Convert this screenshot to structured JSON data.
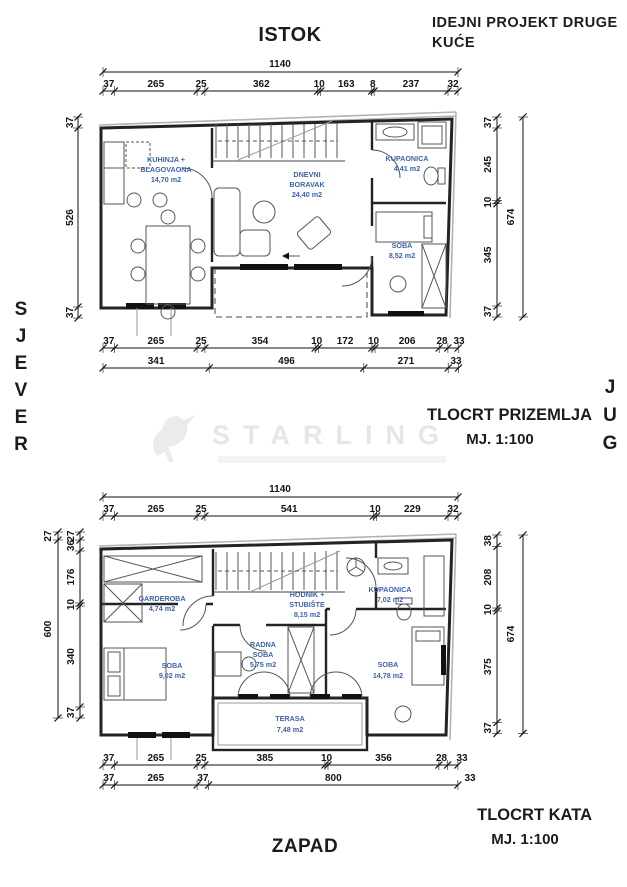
{
  "header": {
    "east_label": "ISTOK",
    "project_line1": "IDEJNI PROJEKT DRUGE",
    "project_line2": "KUĆE"
  },
  "compass": {
    "north": "SJEVER",
    "south": "JUG",
    "west": "ZAPAD"
  },
  "watermark": {
    "brand": "STARLING"
  },
  "colors": {
    "room_label": "#3f62ae",
    "dim_text": "#141414",
    "wall": "#232323",
    "watermark": "#e6e6e6"
  },
  "ground": {
    "caption": "TLOCRT PRIZEMLJA",
    "scale_label": "MJ. 1:100",
    "rooms": {
      "kitchen": {
        "lines": [
          "KUHINJA +",
          "BLAGOVAONA",
          "14,70 m2"
        ]
      },
      "living": {
        "lines": [
          "DNEVNI",
          "BORAVAK",
          "24,40 m2"
        ]
      },
      "bath": {
        "lines": [
          "KUPAONICA",
          "4,41 m2"
        ]
      },
      "bedroom": {
        "lines": [
          "SOBA",
          "8,52 m2"
        ]
      }
    },
    "dims": {
      "top_total": "1140",
      "top": [
        "37",
        "265",
        "25",
        "362",
        "10",
        "163",
        "8",
        "237",
        "32"
      ],
      "left": [
        "37",
        "526",
        "37"
      ],
      "right": [
        "37",
        "245",
        "10",
        "345",
        "37"
      ],
      "right_total": "674",
      "bottom1": [
        "37",
        "265",
        "25",
        "354",
        "10",
        "172",
        "10",
        "206",
        "28",
        "33"
      ],
      "bottom2": [
        "341",
        "496",
        "271",
        "33"
      ]
    }
  },
  "upper": {
    "caption": "TLOCRT KATA",
    "scale_label": "MJ. 1:100",
    "rooms": {
      "garderoba": {
        "lines": [
          "GARDEROBA",
          "4,74 m2"
        ]
      },
      "soba1": {
        "lines": [
          "SOBA",
          "9,02 m2"
        ]
      },
      "radna": {
        "lines": [
          "RADNA",
          "SOBA",
          "5,75 m2"
        ]
      },
      "hodnik": {
        "lines": [
          "HODNIK +",
          "STUBIŠTE",
          "8,15 m2"
        ]
      },
      "kupaonica": {
        "lines": [
          "KUPAONICA",
          "7,02 m2"
        ]
      },
      "soba2": {
        "lines": [
          "SOBA",
          "14,78 m2"
        ]
      },
      "terasa": {
        "lines": [
          "TERASA",
          "7,48 m2"
        ]
      }
    },
    "dims": {
      "top_total": "1140",
      "top": [
        "37",
        "265",
        "25",
        "541",
        "10",
        "229",
        "32"
      ],
      "left_outer": [
        "27",
        "600"
      ],
      "left_inner": [
        "27",
        "36",
        "176",
        "10",
        "340",
        "37"
      ],
      "right": [
        "38",
        "208",
        "10",
        "375",
        "37"
      ],
      "right_total": "674",
      "bottom1": [
        "37",
        "265",
        "25",
        "385",
        "10",
        "356",
        "28",
        "33"
      ],
      "bottom2": [
        "37",
        "265",
        "37",
        "800",
        "33"
      ]
    }
  }
}
